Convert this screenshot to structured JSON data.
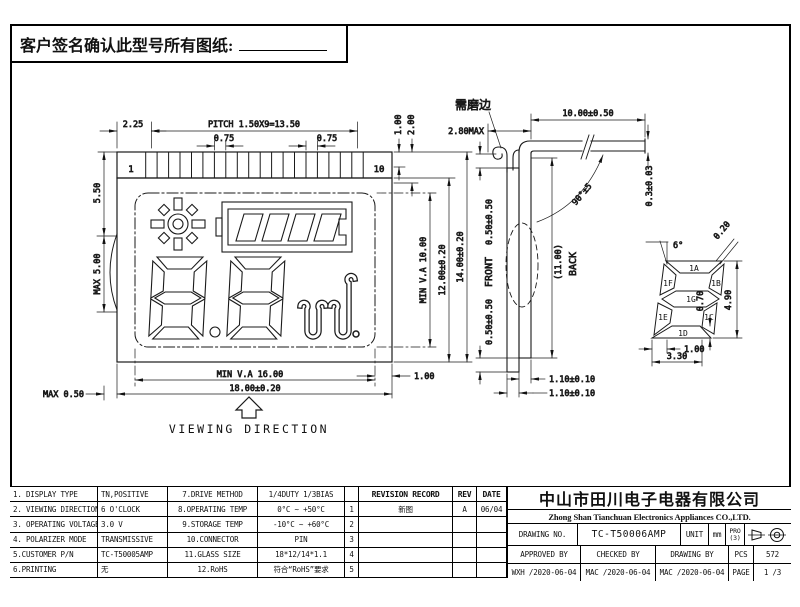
{
  "sheet": {
    "signature_note": "客户签名确认此型号所有图纸:"
  },
  "front": {
    "pin_first": "1",
    "pin_last": "10",
    "d_225": "2.25",
    "d_pitch": "PITCH 1.50X9=13.50",
    "d_075a": "0.75",
    "d_075b": "0.75",
    "d_100t": "1.00",
    "d_200t": "2.00",
    "d_550": "5.50",
    "d_max500": "MAX 5.00",
    "d_max050": "MAX 0.50",
    "d_va10": "MIN V.A 10.00",
    "d_12": "12.00±0.20",
    "d_14": "14.00±0.20",
    "d_100r": "1.00",
    "d_va16": "MIN V.A 16.00",
    "d_18": "18.00±0.20",
    "viewing": "VIEWING DIRECTION"
  },
  "side": {
    "grind_note": "需磨边",
    "d_280": "2.80MAX",
    "d_10": "10.00±0.50",
    "d_angle": "90°±5",
    "d_03": "0.3±0.03",
    "front_label": "FRONT",
    "back_label": "BACK",
    "d_11ref": "(11.00)",
    "d_050t": "0.50±0.50",
    "d_050b": "0.50±0.50",
    "d_110a": "1.10±0.10",
    "d_110b": "1.10±0.10"
  },
  "detail": {
    "seg_a": "1A",
    "seg_f": "1F",
    "seg_b": "1B",
    "seg_g": "1G",
    "seg_e": "1E",
    "seg_c": "1C",
    "seg_d": "1D",
    "d_6deg": "6°",
    "d_020": "0.20",
    "d_490": "4.90",
    "d_070": "0.70",
    "d_100": "1.00",
    "d_330": "3.30"
  },
  "spec": {
    "rows": [
      {
        "k": "1. DISPLAY TYPE",
        "v": "TN,POSITIVE",
        "k2": "7.DRIVE  METHOD",
        "v2": "1/4DUTY 1/3BIAS"
      },
      {
        "k": "2. VIEWING DIRECTION",
        "v": "6  O'CLOCK",
        "k2": "8.OPERATING TEMP",
        "v2": "0°C ~ +50°C"
      },
      {
        "k": "3. OPERATING VOLTAGE",
        "v": "3.0 V",
        "k2": "9.STORAGE  TEMP",
        "v2": "-10°C ~ +60°C"
      },
      {
        "k": "4. POLARIZER MODE",
        "v": "TRANSMISSIVE",
        "k2": "10.CONNECTOR",
        "v2": "PIN"
      },
      {
        "k": "5.CUSTOMER P/N",
        "v": "TC-T50005AMP",
        "k2": "11.GLASS SIZE",
        "v2": "18*12/14*1.1"
      },
      {
        "k": "6.PRINTING",
        "v": "无",
        "k2": "12.RoHS",
        "v2": "符合“RoHS”要求"
      }
    ]
  },
  "revision": {
    "title": "REVISION RECORD",
    "rev_h": "REV",
    "date_h": "DATE",
    "rows": [
      {
        "n": "1",
        "desc": "新图",
        "rev": "A",
        "date": "06/04"
      },
      {
        "n": "2",
        "desc": "",
        "rev": "",
        "date": ""
      },
      {
        "n": "3",
        "desc": "",
        "rev": "",
        "date": ""
      },
      {
        "n": "4",
        "desc": "",
        "rev": "",
        "date": ""
      },
      {
        "n": "5",
        "desc": "",
        "rev": "",
        "date": ""
      }
    ]
  },
  "title_block": {
    "company_cn": "中山市田川电子电器有限公司",
    "company_en": "Zhong Shan Tianchuan Electronics Appliances CO.,LTD.",
    "drawing_no_label": "DRAWING NO.",
    "drawing_no": "TC-T50006AMP",
    "unit_label": "UNIT",
    "unit_value": "mm",
    "pro_label": "PRO",
    "pro_sub": "(3)",
    "approved_label": "APPROVED BY",
    "checked_label": "CHECKED BY",
    "drawing_by_label": "DRAWING BY",
    "pcs_label": "PCS",
    "pcs_value": "572",
    "approved_value": "WXH /2020-06-04",
    "checked_value": "MAC /2020-06-04",
    "drawing_by_value": "MAC /2020-06-04",
    "page_label": "PAGE",
    "page_value": "1 /3"
  }
}
